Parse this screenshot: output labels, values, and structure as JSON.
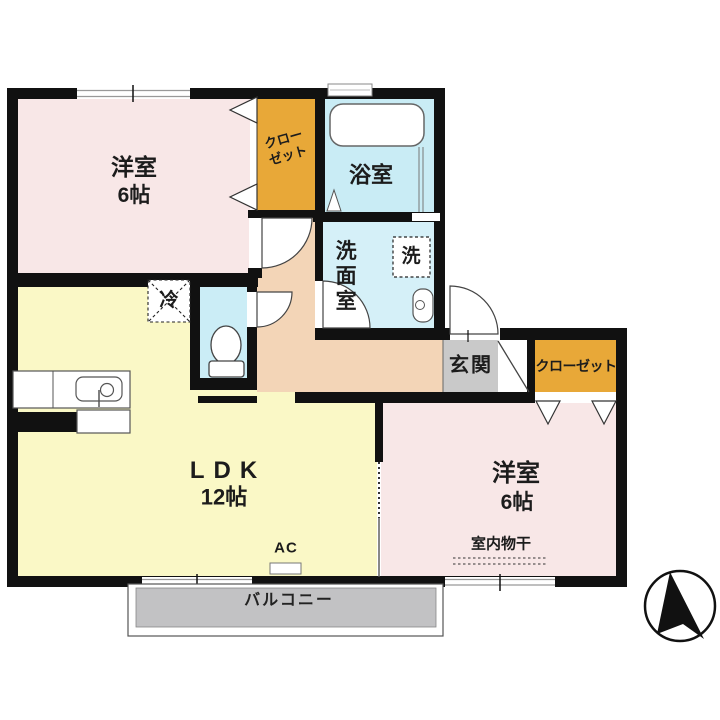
{
  "plan_title": "2LDK floor plan",
  "rooms": {
    "bedroom_top": {
      "name": "洋室",
      "size": "6帖"
    },
    "bedroom_bottom": {
      "name": "洋室",
      "size": "6帖",
      "drying_label": "室内物干"
    },
    "ldk": {
      "name": "LDK",
      "size": "12帖",
      "ac_label": "AC",
      "fridge_label": "冷"
    },
    "bath": {
      "name": "浴室"
    },
    "washroom": {
      "name": "洗面室",
      "washer_label": "洗"
    },
    "closet_top": {
      "line1": "クロー",
      "line2": "ゼット"
    },
    "closet_right": {
      "name": "クローゼット"
    },
    "entrance": {
      "name": "玄関"
    },
    "balcony": {
      "name": "バルコニー"
    }
  },
  "colors": {
    "wall": "#111111",
    "bedroom_pink": "#F8E7E7",
    "ldk_yellow": "#FAF8C6",
    "closet_orange": "#E8A838",
    "bath_blue": "#C9ECF5",
    "washroom_blue": "#D5F0F8",
    "wc_blue": "#CBEDF6",
    "corridor_peach": "#F3D5B7",
    "entrance_gray": "#C9C9C9",
    "balcony_gray": "#C2C2C4"
  }
}
